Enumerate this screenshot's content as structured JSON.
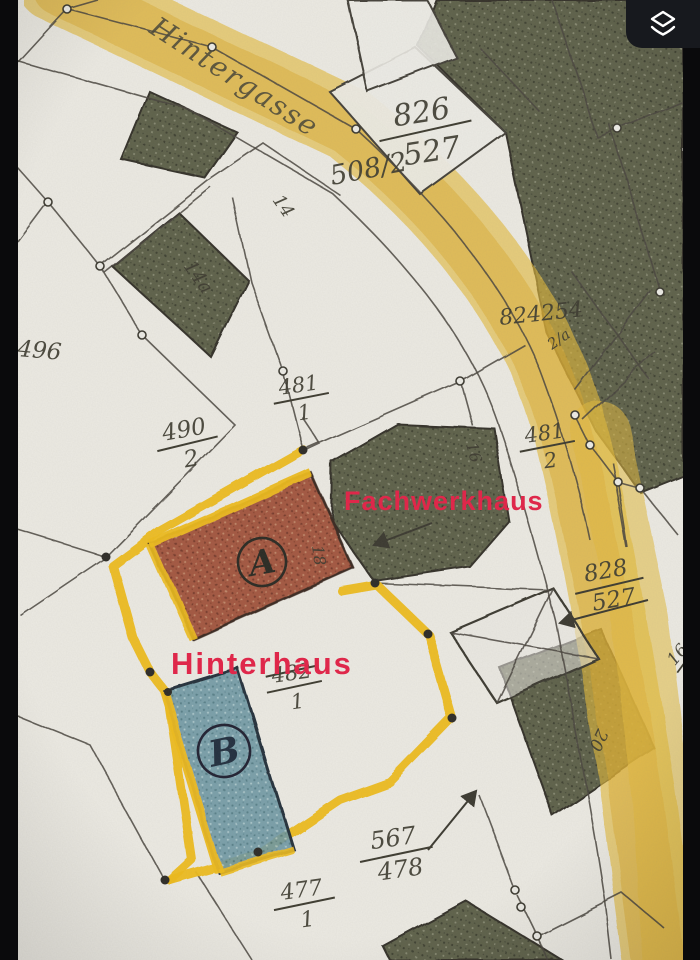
{
  "photo_viewer": {
    "toolbar": {
      "layers_button_icon": "layers-icon"
    }
  },
  "map": {
    "street": {
      "name": "Hintergasse"
    },
    "overlay_annotations": {
      "front_house": "Fachwerkhaus",
      "rear_house": "Hinterhaus"
    },
    "building_marks": {
      "a": "A",
      "b": "B"
    },
    "parcel_labels": {
      "p826": {
        "num": "826",
        "den": "527"
      },
      "p508": {
        "text": "508/2"
      },
      "p496": {
        "text": "496"
      },
      "p490": {
        "num": "490",
        "den": "2"
      },
      "p481_1": {
        "num": "481",
        "den": "1"
      },
      "p481_2": {
        "num": "481",
        "den": "2"
      },
      "p828": {
        "num": "828",
        "den": "527"
      },
      "p482_struck": {
        "num": "482",
        "den": "1"
      },
      "p567": {
        "num": "567",
        "den": "478"
      },
      "p477": {
        "num": "477",
        "den": "1"
      },
      "p_edge_clipped": {
        "num": "16",
        "den": "17"
      },
      "stamp_overlap": {
        "text": "824254"
      },
      "stamp_small": {
        "text": "2/a"
      }
    },
    "house_numbers": {
      "h14": "14",
      "h14a": "14a",
      "h16": "16",
      "h18": "18",
      "h20": "20"
    },
    "colors": {
      "paper": "#eceae3",
      "road_yellow": "#e2b93e",
      "parcel_outline_yellow": "#eebc1f",
      "building_dark_olive": "#5f624c",
      "building_a_red": "#9d4c34",
      "building_b_blue": "#6e98a4",
      "annotation_red": "#e32348",
      "line_ink": "#4a473e"
    }
  }
}
